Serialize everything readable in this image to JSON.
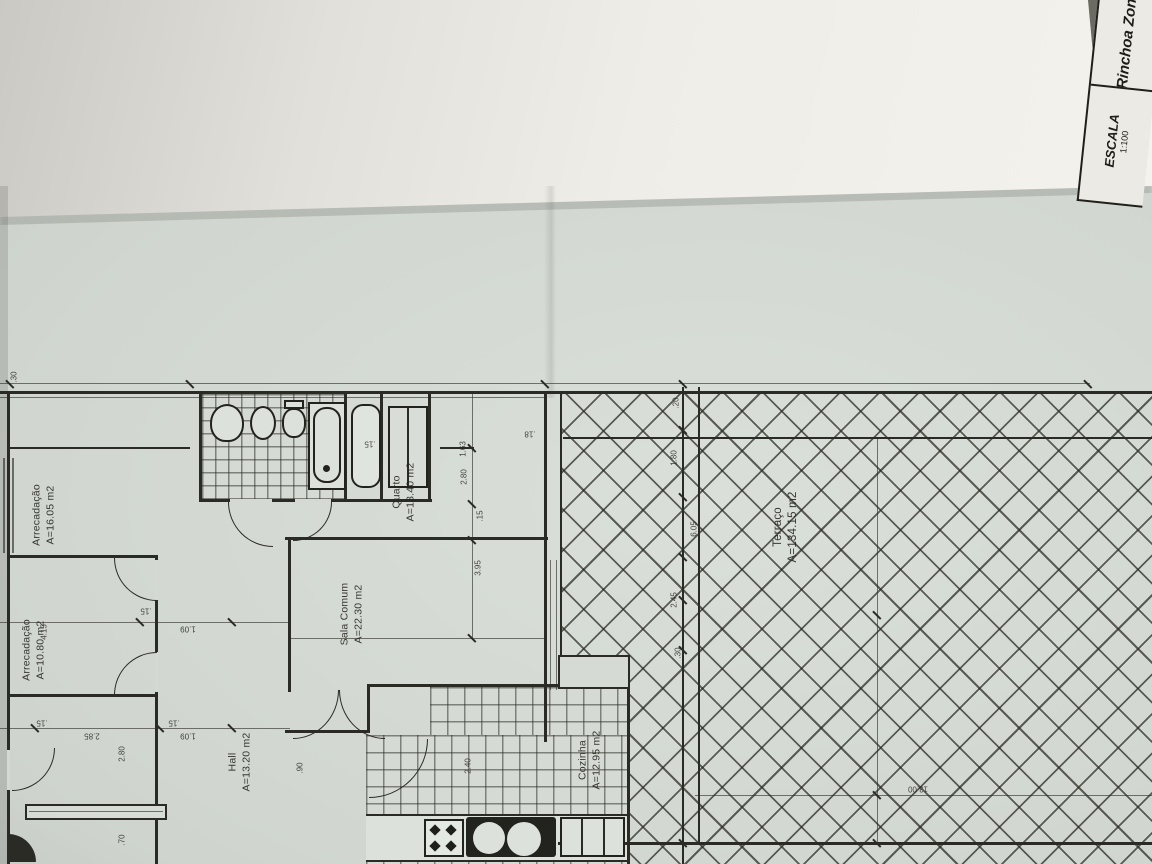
{
  "title_block": {
    "project": "Rinchoa Zona",
    "scale_label": "ESCALA",
    "scale_value": "1:100"
  },
  "rooms": [
    {
      "name": "Arrecadação",
      "area": "A=16.05 m2"
    },
    {
      "name": "Arrecadação",
      "area": "A=10.80 m2"
    },
    {
      "name": "Quarto",
      "area": "A=13.40 m2"
    },
    {
      "name": "Sala Comum",
      "area": "A=22.30 m2"
    },
    {
      "name": "Hall",
      "area": "A=13.20 m2"
    },
    {
      "name": "Cozinha",
      "area": "A=12.95 m2"
    },
    {
      "name": "Terraço",
      "area": "A=134.15 m2"
    }
  ],
  "dims": {
    "d0": ".30",
    "d1": "1.63",
    "d2": "2.80",
    "d3": ".15",
    "d4": "3.95",
    "d5": ".15",
    "d6": ".18",
    "d7": ".20",
    "d8": "1.80",
    "d9": "6.05",
    "d10": "2.45",
    "d11": ".30",
    "d12": ".15",
    "d13": "1.09",
    "d14": ".15",
    "d15": "2.85",
    "d16": ".15",
    "d17": "1.09",
    "d18": "2.80",
    "d19": ".70",
    "d20": "13.00",
    "d21": "4.15",
    "d22": "2.40",
    "d23": ".90"
  }
}
